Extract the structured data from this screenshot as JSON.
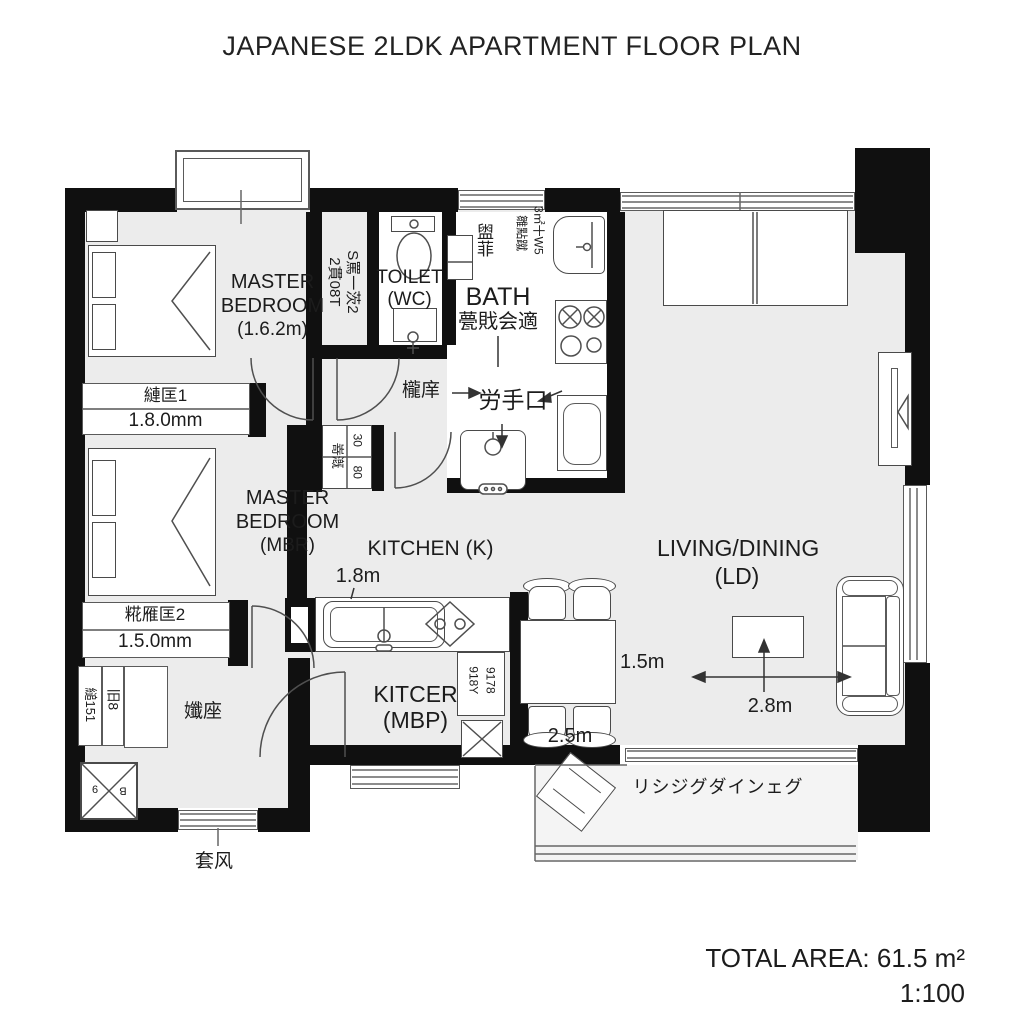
{
  "title": "JAPANESE 2LDK APARTMENT FLOOR PLAN",
  "footer": {
    "total_area_label": "TOTAL AREA: 61.5 m²",
    "scale": "1:100"
  },
  "rooms": {
    "master_bedroom_1": {
      "line1": "MASTER",
      "line2": "BEDROOM",
      "line3": "(1.6.2m)"
    },
    "master_bedroom_2": {
      "line1": "MASTER",
      "line2": "BEDROOM",
      "line3": "(MBR)"
    },
    "toilet": {
      "line1": "TOILET",
      "line2": "(WC)"
    },
    "bath": {
      "line1": "BATH",
      "line2": "甍戝会適"
    },
    "kitchen": {
      "label": "KITCHEN (K)"
    },
    "kitchen2": {
      "line1": "KITCER",
      "line2": "(MBP)"
    },
    "living_dining": {
      "line1": "LIVING/DINING",
      "line2": "(LD)"
    },
    "balcony": {
      "label": "リシジグダインェグ"
    }
  },
  "closets": {
    "closet1": {
      "name": "縺匡1",
      "size": "1.8.0mm"
    },
    "closet2": {
      "name": "糀雁匡2",
      "size": "1.5.0mm"
    }
  },
  "dimensions": {
    "kitchen_sink": "1.8m",
    "dining_depth": "1.5m",
    "dining_width": "2.5m",
    "living_width": "2.8m"
  },
  "annotations": {
    "door_label": "櫳庠",
    "back_door": "労手口",
    "hall_door": "孅座",
    "entrance": "套风",
    "wardrobe_v1": "2貫08T",
    "wardrobe_v2": "S罵一茨2",
    "bath_v1": "雛點蹴",
    "bath_v2": "3㎡十W5",
    "sink_v": "盥菲",
    "hall_v1": "縋151",
    "hall_v2": "旧8",
    "counter_v1": "918Y",
    "counter_v2": "9178",
    "grid_v1": "嵜漑",
    "grid_v2": "30",
    "grid_v3": "80",
    "shaft_a": "9",
    "shaft_b": "B"
  },
  "colors": {
    "wall": "#101010",
    "floor": "#ececec",
    "line": "#4a4a4a",
    "text": "#1c1c1c"
  }
}
